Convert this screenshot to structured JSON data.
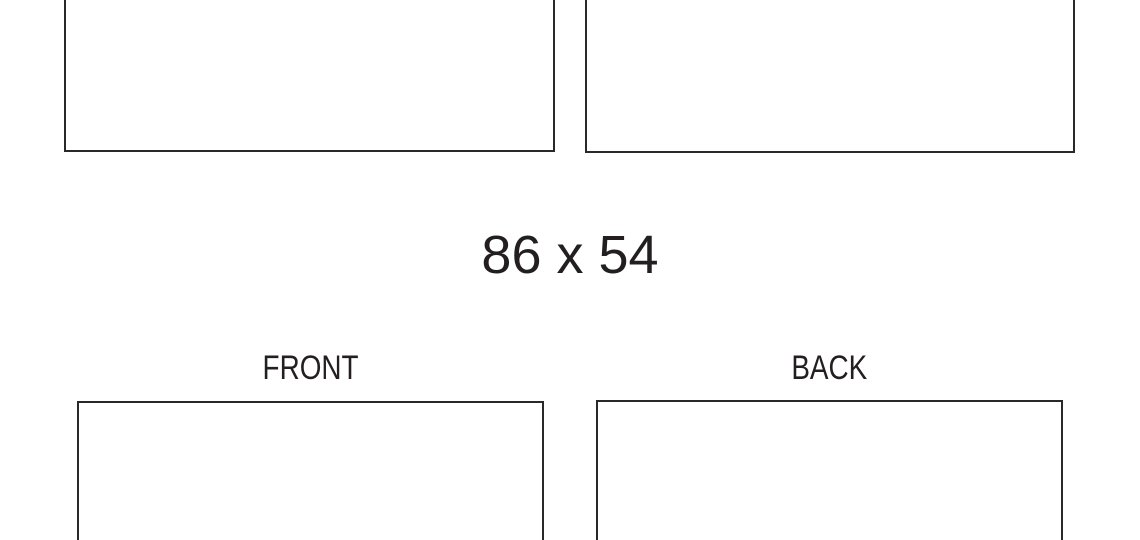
{
  "canvas": {
    "background": "#ffffff"
  },
  "colors": {
    "outline": "#2a2828",
    "text": "#231f20"
  },
  "size_label": "86 x 54",
  "labels": {
    "front": "FRONT",
    "back": "BACK"
  }
}
